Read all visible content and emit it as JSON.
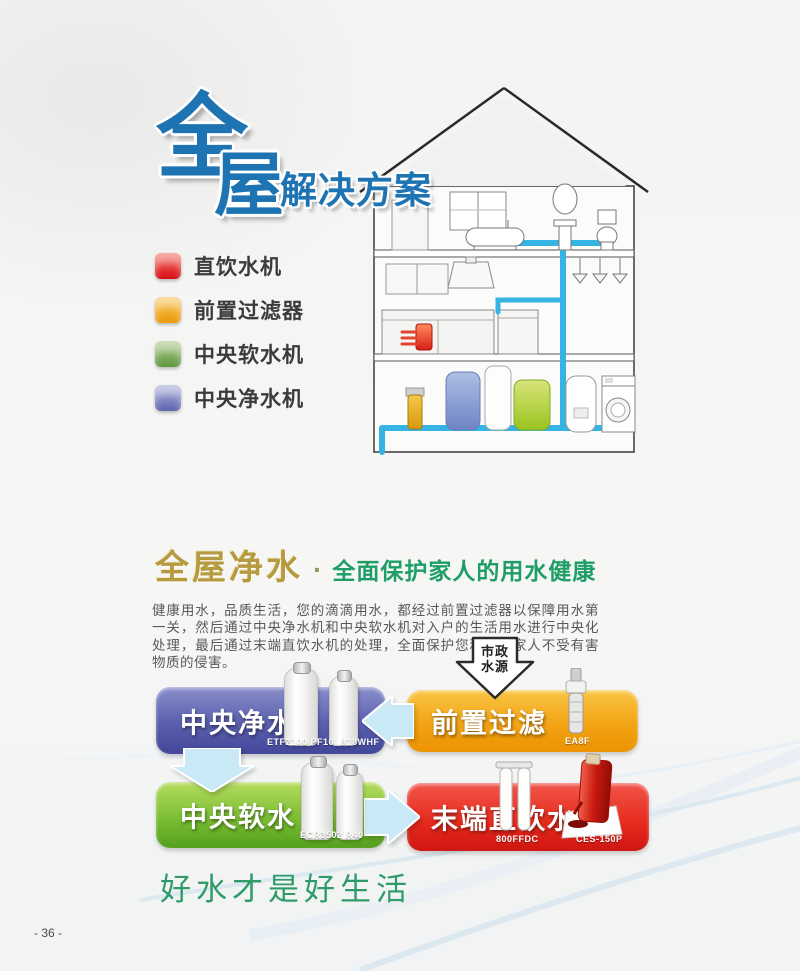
{
  "page": {
    "number": "- 36 -"
  },
  "hero": {
    "title_char1": "全",
    "title_char2": "屋",
    "subtitle": "解决方案",
    "legend": [
      {
        "label": "直饮水机",
        "color_top": "#f56a5e",
        "color_bottom": "#d60f16"
      },
      {
        "label": "前置过滤器",
        "color_top": "#f8c152",
        "color_bottom": "#ec9a0c"
      },
      {
        "label": "中央软水机",
        "color_top": "#a7c487",
        "color_bottom": "#5f9a40"
      },
      {
        "label": "中央净水机",
        "color_top": "#a3a8d8",
        "color_bottom": "#5f66ad"
      }
    ]
  },
  "section": {
    "heading_gold": "全屋净水",
    "heading_dot": "·",
    "heading_green": "全面保护家人的用水健康",
    "body": "健康用水，品质生活，您的滴滴用水，都经过前置过滤器以保障用水第一关，然后通过中央净水机和中央软水机对入户的生活用水进行中央化处理，最后通过末端直饮水机的处理，全面保护您和您的家人不受有害物质的侵害。"
  },
  "flow": {
    "source": {
      "line1": "市政",
      "line2": "水源"
    },
    "steps": [
      {
        "id": "pre-filter",
        "label": "前置过滤",
        "models": [
          "EA8F"
        ]
      },
      {
        "id": "central-purify",
        "label": "中央净水",
        "models": [
          "ETF2100 PF10",
          "818WHF"
        ]
      },
      {
        "id": "central-soften",
        "label": "中央软水",
        "models": [
          "ECR3502 R40"
        ]
      },
      {
        "id": "terminal-drinking",
        "label": "末端直饮水",
        "models": [
          "800FFDC",
          "CES-150P"
        ]
      }
    ],
    "colors": {
      "orange": "#f2a111",
      "purple": "#5a5fae",
      "green": "#76bb30",
      "red": "#e52a1c",
      "arrow_blue": "#c9e9f6",
      "pipe_blue": "#35b4e3"
    }
  },
  "slogan": "好水才是好生活"
}
